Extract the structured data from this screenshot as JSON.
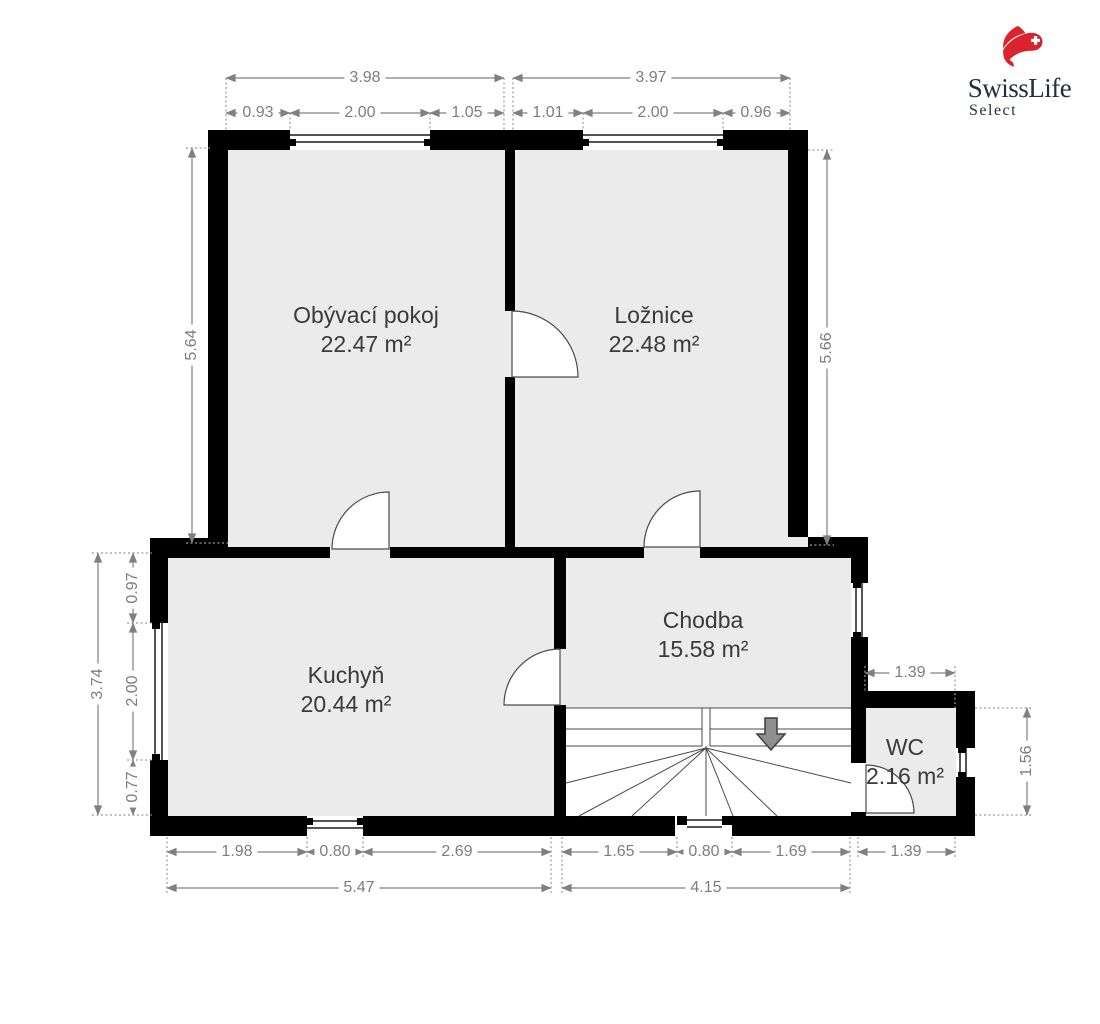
{
  "branding": {
    "title": "SwissLife",
    "subtitle": "Select",
    "accent_red": "#d9232e",
    "text_color": "#232f3a",
    "icon": "swisslife-flag-icon"
  },
  "plan": {
    "rooms": [
      {
        "name": "Obývací pokoj",
        "area": "22.47 m²"
      },
      {
        "name": "Ložnice",
        "area": "22.48 m²"
      },
      {
        "name": "Kuchyň",
        "area": "20.44 m²"
      },
      {
        "name": "Chodba",
        "area": "15.58 m²"
      },
      {
        "name": "WC",
        "area": "2.16 m²"
      }
    ],
    "dims": {
      "top_totals": [
        "3.98",
        "3.97"
      ],
      "top_parts": [
        "0.93",
        "2.00",
        "1.05",
        "1.01",
        "2.00",
        "0.96"
      ],
      "left_height": "5.64",
      "right_height": "5.66",
      "kitchen_left_total": "3.74",
      "kitchen_left_parts": [
        "0.97",
        "2.00",
        "0.77"
      ],
      "bottom_parts": [
        "1.98",
        "0.80",
        "2.69",
        "1.65",
        "0.80",
        "1.69"
      ],
      "bottom_totals": [
        "5.47",
        "4.15"
      ],
      "wc_width_top": "1.39",
      "wc_width_bottom": "1.39",
      "wc_height": "1.56"
    },
    "colors": {
      "wall": "#000000",
      "room_fill": "#ebebeb",
      "stairs_fill": "#ffffff",
      "dim_line": "#808080",
      "room_label": "#3a3a3a",
      "stairs_arrow": "#8f8f8f"
    },
    "icons": {
      "stairs_direction": "down-arrow-icon"
    }
  }
}
